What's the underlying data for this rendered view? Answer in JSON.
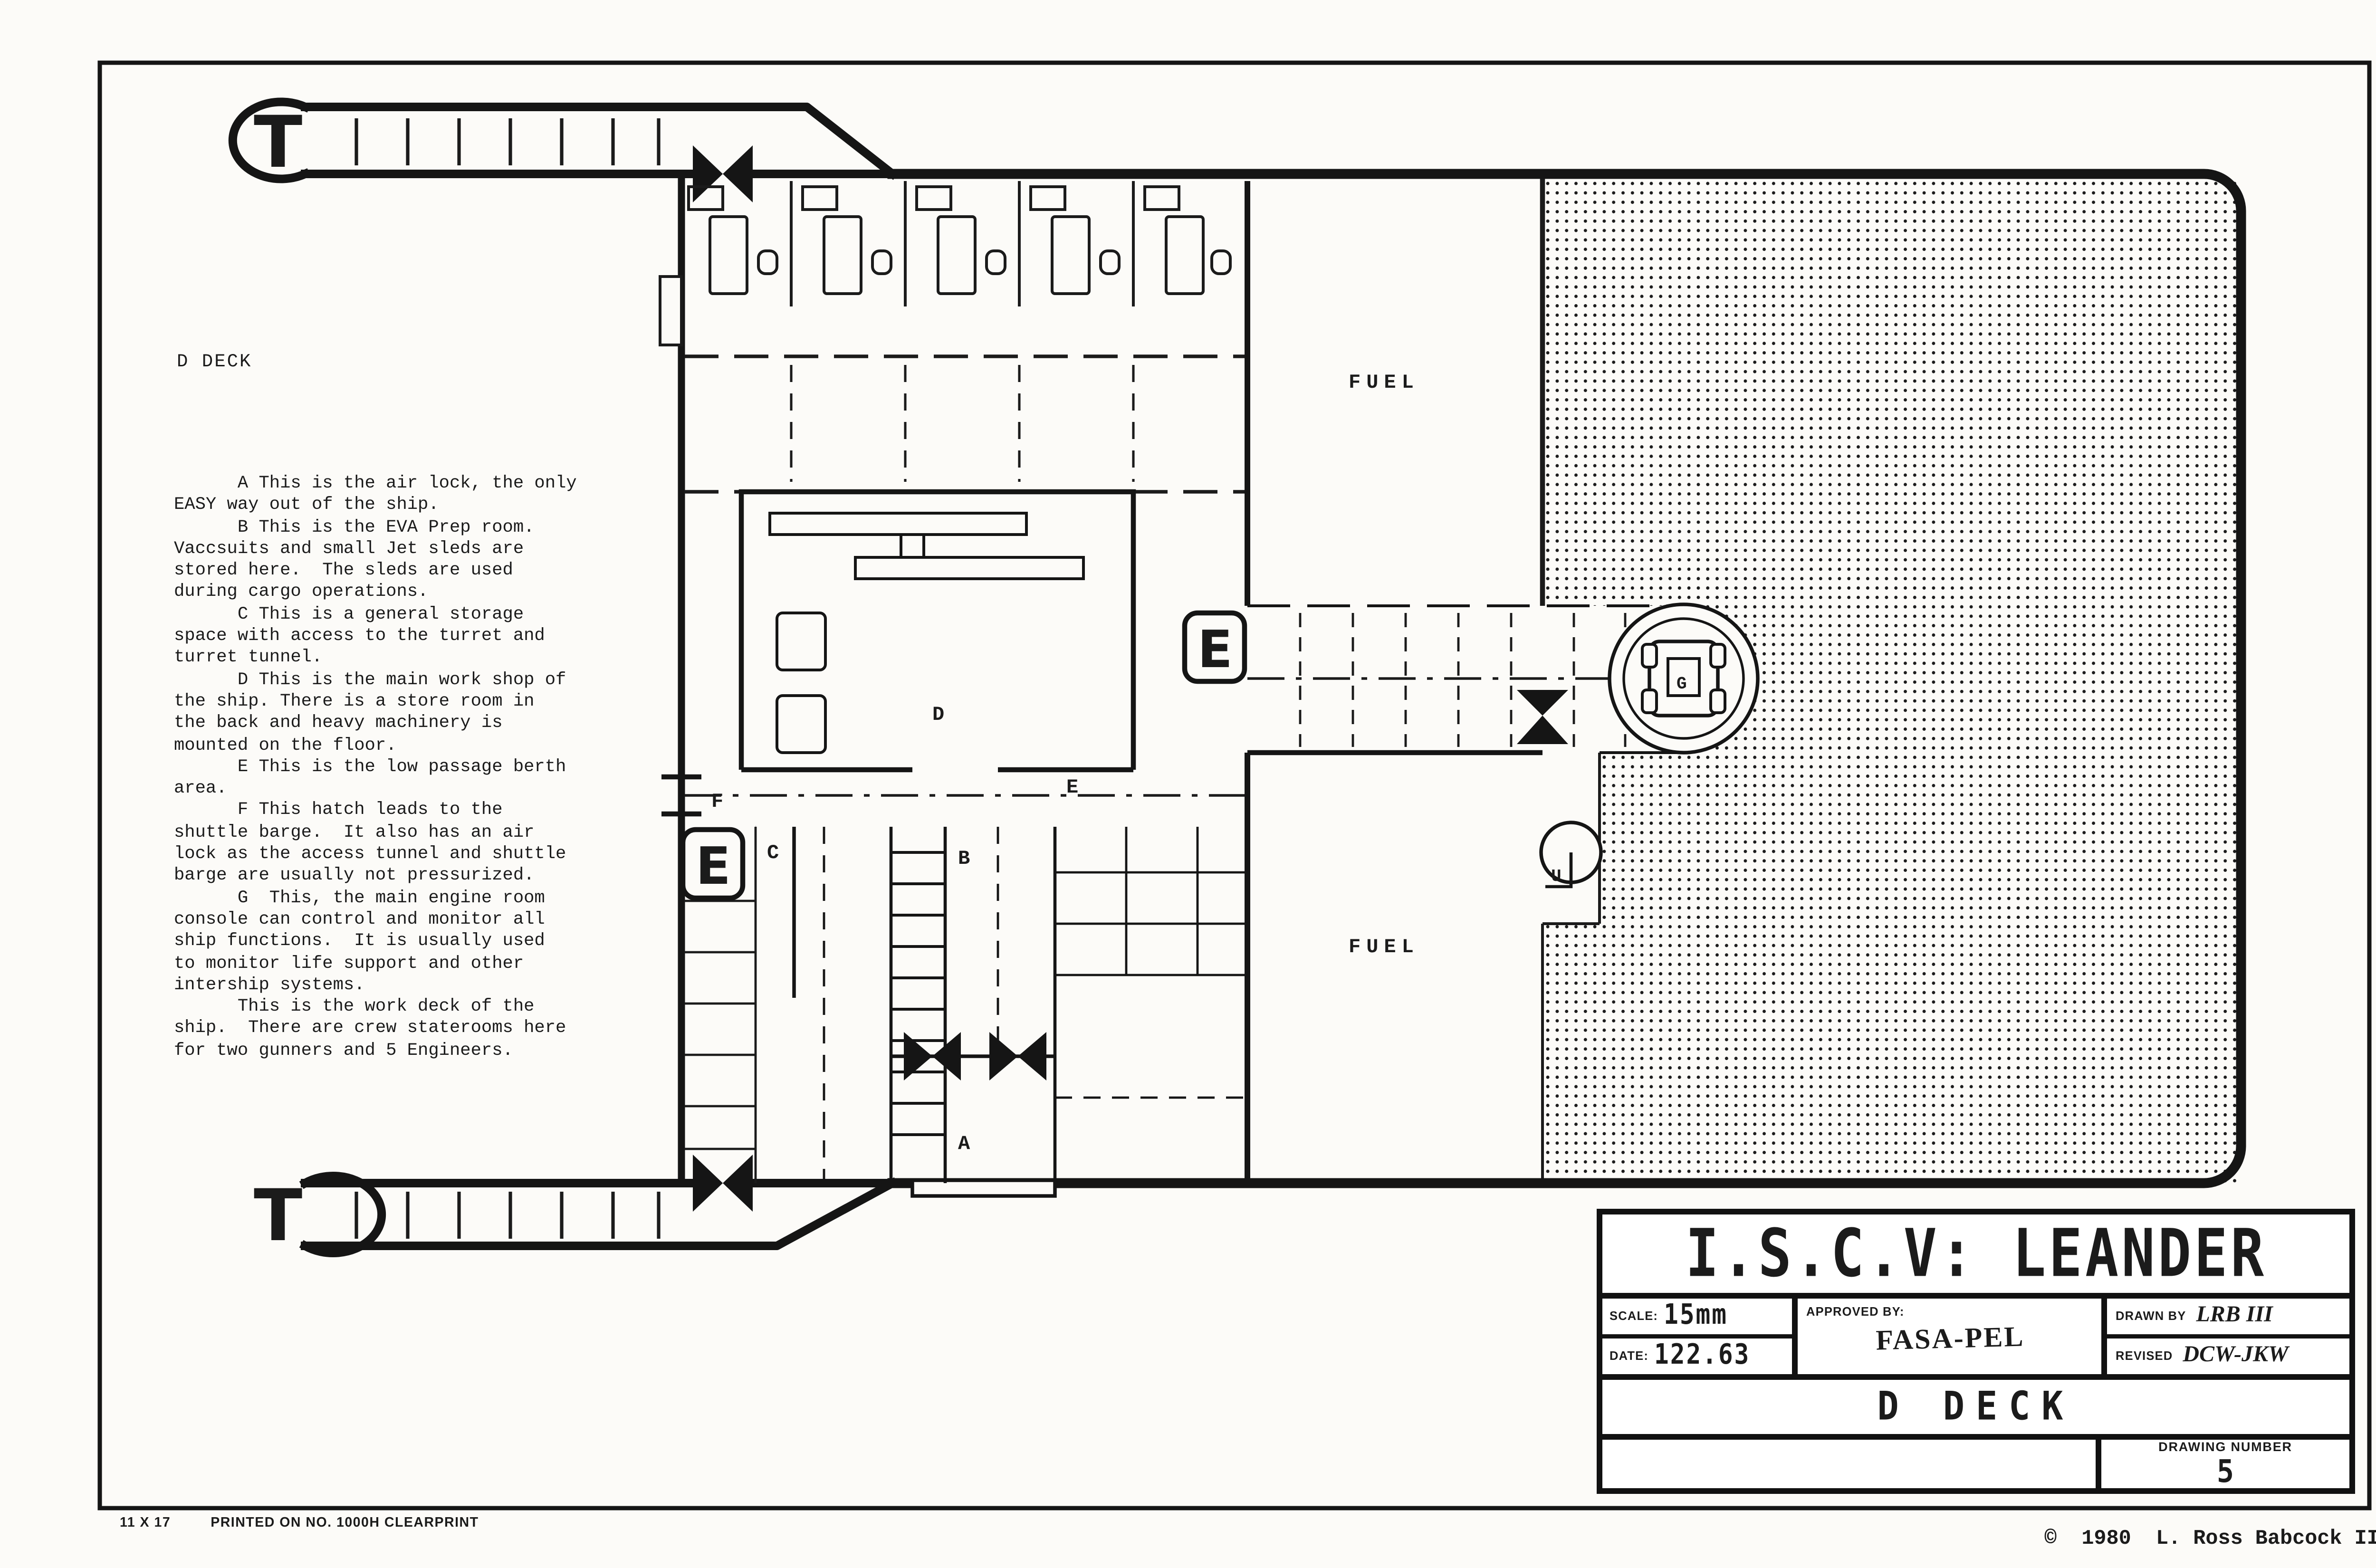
{
  "footer": {
    "size_label": "11 X 17",
    "print_note": "PRINTED ON NO. 1000H CLEARPRINT",
    "copyright": "©  1980  L. Ross Babcock III"
  },
  "notes": {
    "heading": "D DECK",
    "body": "      A This is the air lock, the only\nEASY way out of the ship.\n      B This is the EVA Prep room.\nVaccsuits and small Jet sleds are\nstored here.  The sleds are used\nduring cargo operations.\n      C This is a general storage\nspace with access to the turret and\nturret tunnel.\n      D This is the main work shop of\nthe ship. There is a store room in\nthe back and heavy machinery is\nmounted on the floor.\n      E This is the low passage berth\narea.\n      F This hatch leads to the\nshuttle barge.  It also has an air\nlock as the access tunnel and shuttle\nbarge are usually not pressurized.\n      G  This, the main engine room\nconsole can control and monitor all\nship functions.  It is usually used\nto monitor life support and other\nintership systems.\n      This is the work deck of the\nship.  There are crew staterooms here\nfor two gunners and 5 Engineers."
  },
  "plan": {
    "labels": {
      "turret_top": "T",
      "turret_bottom": "T",
      "airlock": "A",
      "eva_prep": "B",
      "storage": "C",
      "workshop": "D",
      "berth_area": "E",
      "berth_box_left": "E",
      "berth_box_mid": "E",
      "shuttle_hatch": "F",
      "engine_console": "G",
      "ladder_up": "U",
      "fuel_upper": "FUEL",
      "fuel_lower": "FUEL"
    }
  },
  "title_block": {
    "title": "I.S.C.V: LEANDER",
    "scale_label": "SCALE:",
    "scale_value": "15mm",
    "date_label": "DATE:",
    "date_value": "122.63",
    "approved_label": "APPROVED BY:",
    "approved_value": "FASA-PEL",
    "drawn_label": "DRAWN BY",
    "drawn_value": "LRB III",
    "revised_label": "REVISED",
    "revised_value": "DCW-JKW",
    "deck_name": "D DECK",
    "drawing_number_label": "DRAWING NUMBER",
    "drawing_number": "5"
  },
  "colors": {
    "ink": "#1b1b1b",
    "paper": "#fcfbf8"
  }
}
